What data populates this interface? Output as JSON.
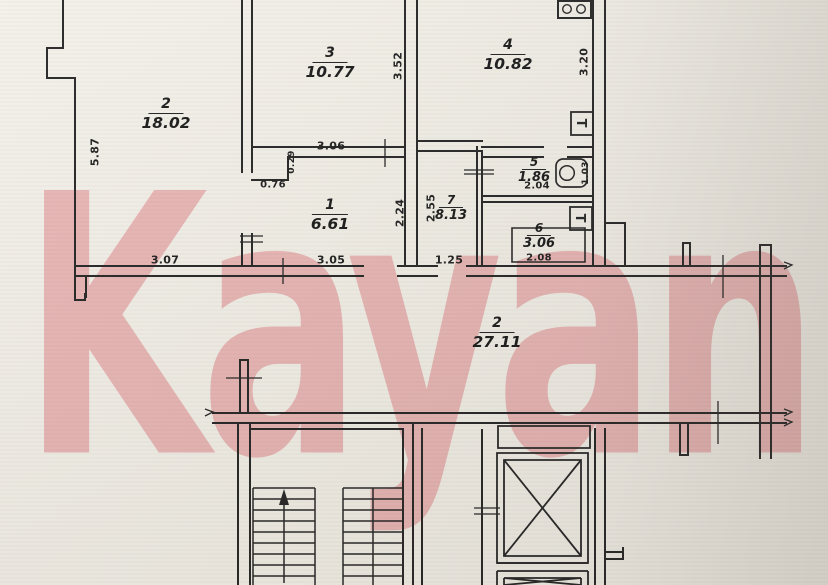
{
  "watermark": {
    "text": "Kayan",
    "color": "#f4bcc1"
  },
  "plan": {
    "type": "floor-plan",
    "line_color": "#262626",
    "rooms": [
      {
        "number": "2",
        "area": "18.02"
      },
      {
        "number": "3",
        "area": "10.77"
      },
      {
        "number": "4",
        "area": "10.82"
      },
      {
        "number": "1",
        "area": "6.61"
      },
      {
        "number": "5",
        "area": "1.86"
      },
      {
        "number": "7",
        "area": "8.13"
      },
      {
        "number": "6",
        "area": "3.06"
      },
      {
        "number": "2",
        "area": "27.11"
      }
    ],
    "dimensions": [
      {
        "value": "5.87"
      },
      {
        "value": "3.07"
      },
      {
        "value": "3.05"
      },
      {
        "value": "1.25"
      },
      {
        "value": "3.06"
      },
      {
        "value": "0.76"
      },
      {
        "value": "0.29"
      },
      {
        "value": "2.24"
      },
      {
        "value": "3.52"
      },
      {
        "value": "2.55"
      },
      {
        "value": "3.20"
      },
      {
        "value": "2.04"
      },
      {
        "value": "1.03"
      },
      {
        "value": "2.08"
      }
    ],
    "icons": {
      "towel_dryer_label": "Т",
      "stove": "stove-burners",
      "toilet": "toilet",
      "bathtub": "bathtub",
      "stairs_arrow": "up-arrow",
      "elevator": "elevator-shaft"
    }
  }
}
